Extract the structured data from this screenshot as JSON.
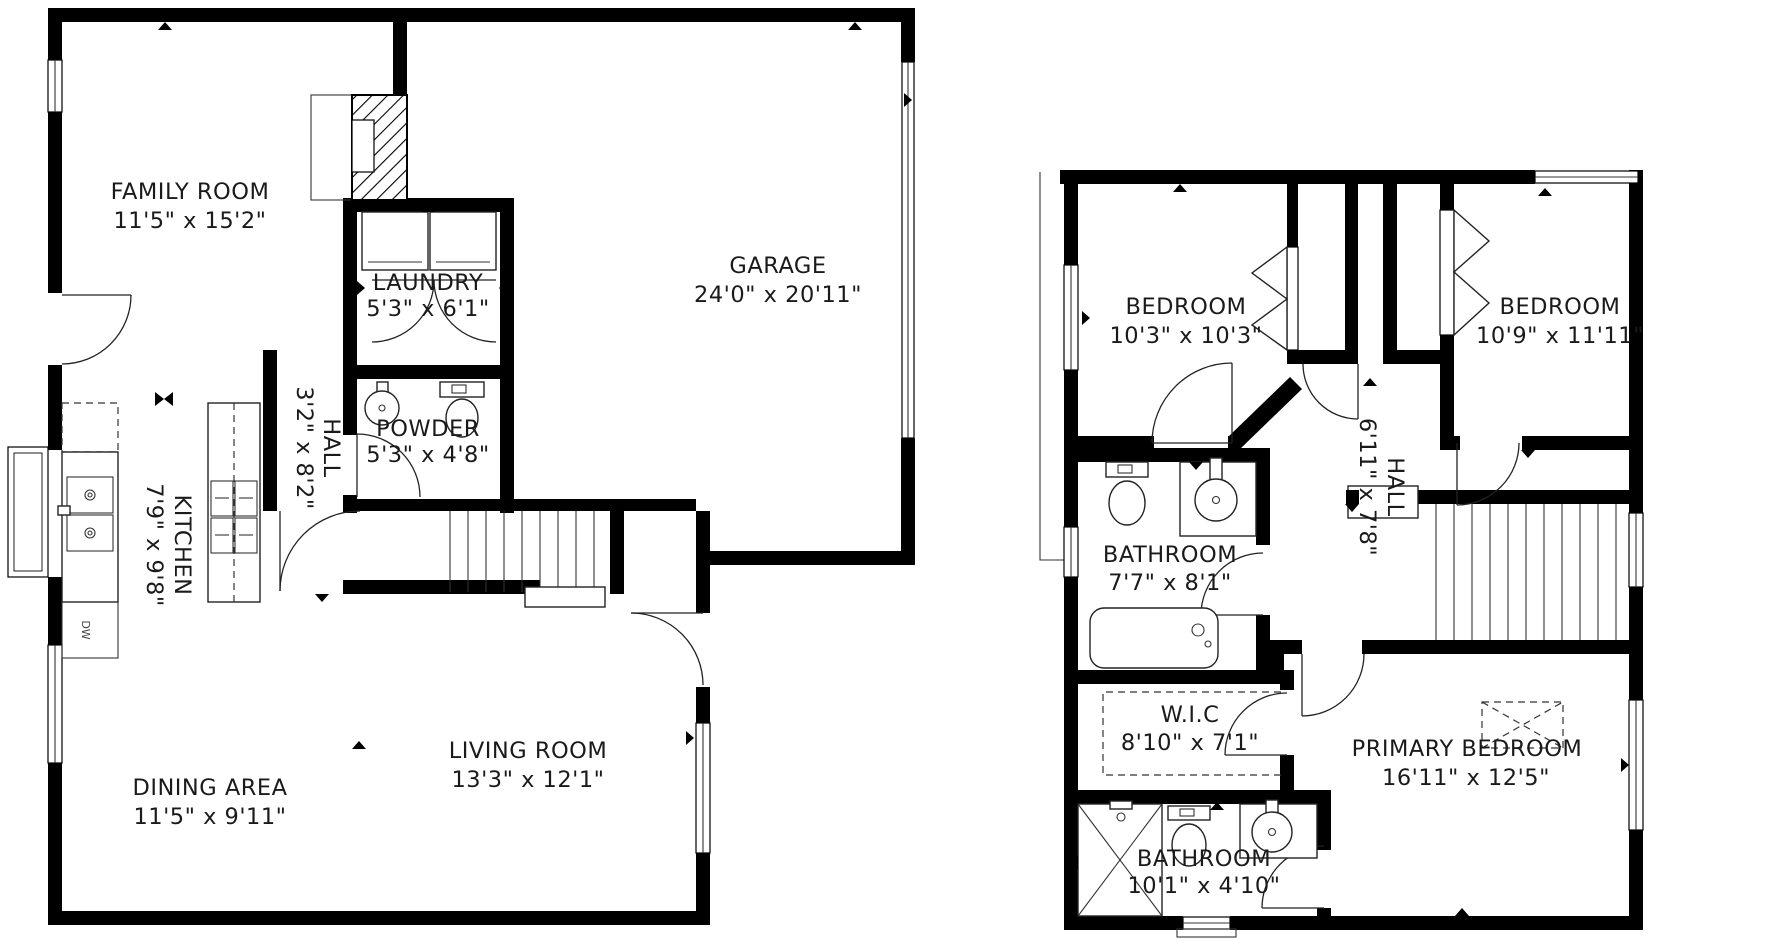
{
  "document": {
    "type": "floor-plan",
    "floor_count": 2
  },
  "colors": {
    "wall": "#000000",
    "background": "#ffffff",
    "text": "#1a1a1a"
  },
  "floors": [
    {
      "position": "left",
      "rooms": [
        {
          "name": "FAMILY ROOM",
          "dims": "11'5\" x 15'2\""
        },
        {
          "name": "LAUNDRY",
          "dims": "5'3\" x 6'1\""
        },
        {
          "name": "GARAGE",
          "dims": "24'0\" x 20'11\""
        },
        {
          "name": "POWDER",
          "dims": "5'3\" x 4'8\""
        },
        {
          "name": "HALL",
          "dims": "3'2\" x 8'2\""
        },
        {
          "name": "KITCHEN",
          "dims": "7'9\" x 9'8\""
        },
        {
          "name": "LIVING ROOM",
          "dims": "13'3\" x 12'1\""
        },
        {
          "name": "DINING AREA",
          "dims": "11'5\" x 9'11\""
        }
      ],
      "appliances": {
        "dishwasher": "DW"
      }
    },
    {
      "position": "right",
      "rooms": [
        {
          "name": "BEDROOM",
          "dims": "10'3\" x 10'3\""
        },
        {
          "name": "BEDROOM",
          "dims": "10'9\" x 11'11\""
        },
        {
          "name": "BATHROOM",
          "dims": "7'7\" x 8'1\""
        },
        {
          "name": "HALL",
          "dims": "6'11\" x 7'8\""
        },
        {
          "name": "W.I.C",
          "dims": "8'10\" x 7'1\""
        },
        {
          "name": "PRIMARY BEDROOM",
          "dims": "16'11\" x 12'5\""
        },
        {
          "name": "BATHROOM",
          "dims": "10'1\" x 4'10\""
        }
      ]
    }
  ]
}
